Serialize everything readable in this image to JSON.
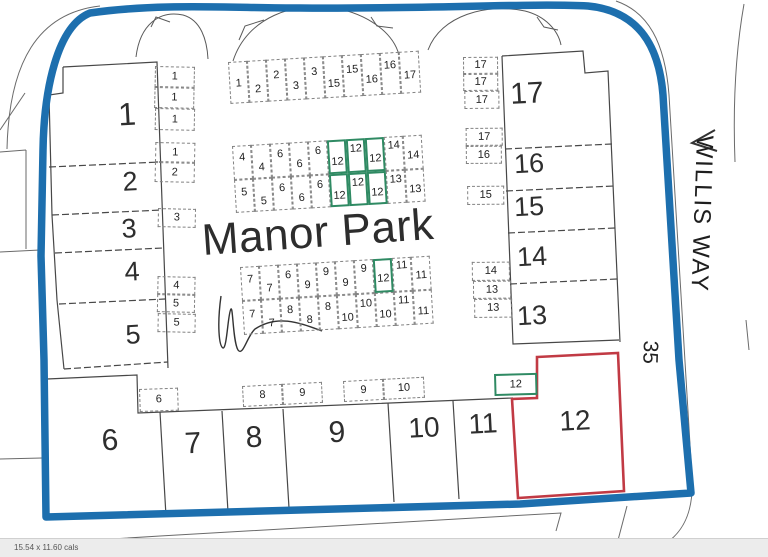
{
  "title": {
    "text": "Manor Park"
  },
  "street": {
    "name": "WILLIS WAY",
    "number": "35"
  },
  "status_bar": {
    "left_text": "15.54 x 11.60 cals"
  },
  "colors": {
    "boundary": "#1d6fae",
    "highlight_red": "#c13a44",
    "highlight_green": "#2f8a63",
    "plot_line": "#474747"
  },
  "plots": [
    {
      "label": "1",
      "x": 127,
      "y": 114,
      "fs": 32
    },
    {
      "label": "2",
      "x": 130,
      "y": 182,
      "fs": 27
    },
    {
      "label": "3",
      "x": 129,
      "y": 229,
      "fs": 27
    },
    {
      "label": "4",
      "x": 132,
      "y": 272,
      "fs": 27
    },
    {
      "label": "5",
      "x": 133,
      "y": 335,
      "fs": 27
    },
    {
      "label": "6",
      "x": 110,
      "y": 441,
      "fs": 30
    },
    {
      "label": "7",
      "x": 193,
      "y": 444,
      "fs": 30
    },
    {
      "label": "8",
      "x": 254,
      "y": 438,
      "fs": 30
    },
    {
      "label": "9",
      "x": 337,
      "y": 433,
      "fs": 30
    },
    {
      "label": "10",
      "x": 424,
      "y": 428,
      "fs": 28
    },
    {
      "label": "11",
      "x": 483,
      "y": 424,
      "fs": 28
    },
    {
      "label": "12",
      "x": 575,
      "y": 421,
      "fs": 28
    },
    {
      "label": "13",
      "x": 532,
      "y": 316,
      "fs": 27
    },
    {
      "label": "14",
      "x": 532,
      "y": 257,
      "fs": 27
    },
    {
      "label": "15",
      "x": 529,
      "y": 207,
      "fs": 27
    },
    {
      "label": "16",
      "x": 529,
      "y": 164,
      "fs": 27
    },
    {
      "label": "17",
      "x": 527,
      "y": 94,
      "fs": 30
    }
  ],
  "garage_groups": [
    {
      "name": "garage-strip-left",
      "x": 155,
      "y": 66,
      "a": 1.2,
      "cells": [
        {
          "l": "1",
          "dx": 0,
          "dy": 0,
          "w": 40,
          "h": 21,
          "lo": 0
        },
        {
          "l": "1",
          "dx": 0,
          "dy": 21,
          "w": 40,
          "h": 21,
          "lo": 0
        },
        {
          "l": "1",
          "dx": 1,
          "dy": 42,
          "w": 40,
          "h": 22,
          "lo": 0
        },
        {
          "l": "1",
          "dx": 2,
          "dy": 76,
          "w": 40,
          "h": 20,
          "lo": 0
        },
        {
          "l": "2",
          "dx": 2,
          "dy": 96,
          "w": 40,
          "h": 20,
          "lo": 0
        },
        {
          "l": "3",
          "dx": 6,
          "dy": 142,
          "w": 38,
          "h": 19,
          "lo": 0
        },
        {
          "l": "4",
          "dx": 7,
          "dy": 210,
          "w": 38,
          "h": 18,
          "lo": 0
        },
        {
          "l": "5",
          "dx": 7,
          "dy": 228,
          "w": 38,
          "h": 18,
          "lo": 0
        },
        {
          "l": "5",
          "dx": 8,
          "dy": 247,
          "w": 38,
          "h": 19,
          "lo": 0
        }
      ]
    },
    {
      "name": "garage-row-top",
      "x": 228,
      "y": 62,
      "a": -3.4,
      "cells": [
        {
          "l": "1",
          "dx": 0,
          "dy": 0,
          "w": 19,
          "h": 42,
          "lo": 1
        },
        {
          "l": "2",
          "dx": 19,
          "dy": 0,
          "w": 19,
          "h": 42,
          "lo": 8
        },
        {
          "l": "2",
          "dx": 38,
          "dy": 0,
          "w": 19,
          "h": 42,
          "lo": -5
        },
        {
          "l": "3",
          "dx": 57,
          "dy": 0,
          "w": 19,
          "h": 42,
          "lo": 7
        },
        {
          "l": "3",
          "dx": 76,
          "dy": 0,
          "w": 19,
          "h": 42,
          "lo": -6
        },
        {
          "l": "15",
          "dx": 95,
          "dy": 0,
          "w": 19,
          "h": 42,
          "lo": 7
        },
        {
          "l": "15",
          "dx": 114,
          "dy": 0,
          "w": 19,
          "h": 42,
          "lo": -6
        },
        {
          "l": "16",
          "dx": 133,
          "dy": 0,
          "w": 19,
          "h": 42,
          "lo": 5
        },
        {
          "l": "16",
          "dx": 152,
          "dy": 0,
          "w": 19,
          "h": 42,
          "lo": -8
        },
        {
          "l": "17",
          "dx": 171,
          "dy": 0,
          "w": 20,
          "h": 42,
          "lo": 3
        }
      ]
    },
    {
      "name": "garage-block-upper",
      "x": 232,
      "y": 146,
      "a": -3.4,
      "cells": [
        {
          "l": "4",
          "dx": 0,
          "dy": 0,
          "w": 19,
          "h": 34,
          "lo": -5
        },
        {
          "l": "4",
          "dx": 19,
          "dy": 0,
          "w": 19,
          "h": 34,
          "lo": 6
        },
        {
          "l": "6",
          "dx": 38,
          "dy": 0,
          "w": 19,
          "h": 34,
          "lo": -6
        },
        {
          "l": "6",
          "dx": 57,
          "dy": 0,
          "w": 19,
          "h": 34,
          "lo": 5
        },
        {
          "l": "6",
          "dx": 76,
          "dy": 0,
          "w": 19,
          "h": 34,
          "lo": -7
        },
        {
          "l": "12",
          "dx": 95,
          "dy": 0,
          "w": 19,
          "h": 34,
          "lo": 5,
          "g": true
        },
        {
          "l": "12",
          "dx": 114,
          "dy": 0,
          "w": 19,
          "h": 34,
          "lo": -7,
          "g": true
        },
        {
          "l": "12",
          "dx": 133,
          "dy": 0,
          "w": 19,
          "h": 34,
          "lo": 4,
          "g": true
        },
        {
          "l": "14",
          "dx": 152,
          "dy": 0,
          "w": 19,
          "h": 34,
          "lo": -8
        },
        {
          "l": "14",
          "dx": 171,
          "dy": 0,
          "w": 19,
          "h": 34,
          "lo": 3
        },
        {
          "l": "5",
          "dx": 0,
          "dy": 34,
          "w": 19,
          "h": 33,
          "lo": -3
        },
        {
          "l": "5",
          "dx": 19,
          "dy": 34,
          "w": 19,
          "h": 33,
          "lo": 7
        },
        {
          "l": "6",
          "dx": 38,
          "dy": 34,
          "w": 19,
          "h": 33,
          "lo": -5
        },
        {
          "l": "6",
          "dx": 57,
          "dy": 34,
          "w": 19,
          "h": 33,
          "lo": 6
        },
        {
          "l": "6",
          "dx": 76,
          "dy": 34,
          "w": 19,
          "h": 33,
          "lo": -6
        },
        {
          "l": "12",
          "dx": 95,
          "dy": 34,
          "w": 19,
          "h": 33,
          "lo": 6,
          "g": true
        },
        {
          "l": "12",
          "dx": 114,
          "dy": 34,
          "w": 19,
          "h": 33,
          "lo": -6,
          "g": true
        },
        {
          "l": "12",
          "dx": 133,
          "dy": 34,
          "w": 19,
          "h": 33,
          "lo": 5,
          "g": true
        },
        {
          "l": "13",
          "dx": 152,
          "dy": 34,
          "w": 19,
          "h": 33,
          "lo": -7
        },
        {
          "l": "13",
          "dx": 171,
          "dy": 34,
          "w": 19,
          "h": 33,
          "lo": 4
        }
      ]
    },
    {
      "name": "garage-block-lower",
      "x": 240,
      "y": 267,
      "a": -3.4,
      "cells": [
        {
          "l": "7",
          "dx": 0,
          "dy": 0,
          "w": 19,
          "h": 34,
          "lo": -4
        },
        {
          "l": "7",
          "dx": 19,
          "dy": 0,
          "w": 19,
          "h": 34,
          "lo": 6
        },
        {
          "l": "6",
          "dx": 38,
          "dy": 0,
          "w": 19,
          "h": 34,
          "lo": -6
        },
        {
          "l": "9",
          "dx": 57,
          "dy": 0,
          "w": 19,
          "h": 34,
          "lo": 5
        },
        {
          "l": "9",
          "dx": 76,
          "dy": 0,
          "w": 19,
          "h": 34,
          "lo": -7
        },
        {
          "l": "9",
          "dx": 95,
          "dy": 0,
          "w": 19,
          "h": 34,
          "lo": 5
        },
        {
          "l": "9",
          "dx": 114,
          "dy": 0,
          "w": 19,
          "h": 34,
          "lo": -8
        },
        {
          "l": "12",
          "dx": 133,
          "dy": 0,
          "w": 19,
          "h": 34,
          "lo": 3,
          "g": true
        },
        {
          "l": "11",
          "dx": 152,
          "dy": 0,
          "w": 19,
          "h": 34,
          "lo": -9
        },
        {
          "l": "11",
          "dx": 171,
          "dy": 0,
          "w": 19,
          "h": 34,
          "lo": 2
        },
        {
          "l": "7",
          "dx": 0,
          "dy": 34,
          "w": 19,
          "h": 34,
          "lo": -3
        },
        {
          "l": "7",
          "dx": 19,
          "dy": 34,
          "w": 19,
          "h": 34,
          "lo": 7
        },
        {
          "l": "8",
          "dx": 38,
          "dy": 34,
          "w": 19,
          "h": 34,
          "lo": -5
        },
        {
          "l": "8",
          "dx": 57,
          "dy": 34,
          "w": 19,
          "h": 34,
          "lo": 6
        },
        {
          "l": "8",
          "dx": 76,
          "dy": 34,
          "w": 19,
          "h": 34,
          "lo": -6
        },
        {
          "l": "10",
          "dx": 95,
          "dy": 34,
          "w": 19,
          "h": 34,
          "lo": 6
        },
        {
          "l": "10",
          "dx": 114,
          "dy": 34,
          "w": 19,
          "h": 34,
          "lo": -7
        },
        {
          "l": "10",
          "dx": 133,
          "dy": 34,
          "w": 19,
          "h": 34,
          "lo": 5
        },
        {
          "l": "11",
          "dx": 152,
          "dy": 34,
          "w": 19,
          "h": 34,
          "lo": -8
        },
        {
          "l": "11",
          "dx": 171,
          "dy": 34,
          "w": 19,
          "h": 34,
          "lo": 4
        }
      ]
    },
    {
      "name": "garage-col-right",
      "x": 463,
      "y": 57,
      "a": -0.5,
      "cells": [
        {
          "l": "17",
          "dx": 0,
          "dy": 0,
          "w": 35,
          "h": 17,
          "lo": 0
        },
        {
          "l": "17",
          "dx": 0,
          "dy": 17,
          "w": 35,
          "h": 17,
          "lo": 0
        },
        {
          "l": "17",
          "dx": 1,
          "dy": 34,
          "w": 35,
          "h": 18,
          "lo": 0
        },
        {
          "l": "17",
          "dx": 2,
          "dy": 71,
          "w": 37,
          "h": 18,
          "lo": 0
        },
        {
          "l": "16",
          "dx": 2,
          "dy": 89,
          "w": 36,
          "h": 18,
          "lo": 0
        },
        {
          "l": "15",
          "dx": 3,
          "dy": 129,
          "w": 37,
          "h": 19,
          "lo": 0
        },
        {
          "l": "14",
          "dx": 7,
          "dy": 205,
          "w": 38,
          "h": 19,
          "lo": 0
        },
        {
          "l": "13",
          "dx": 8,
          "dy": 224,
          "w": 38,
          "h": 18,
          "lo": 0
        },
        {
          "l": "13",
          "dx": 9,
          "dy": 242,
          "w": 38,
          "h": 19,
          "lo": 0
        }
      ]
    },
    {
      "name": "garage-cell-6",
      "x": 139,
      "y": 389,
      "a": -2,
      "cells": [
        {
          "l": "6",
          "dx": 0,
          "dy": 0,
          "w": 39,
          "h": 23,
          "lo": 0
        }
      ]
    },
    {
      "name": "garage-cells-8-9",
      "x": 242,
      "y": 386,
      "a": -3,
      "cells": [
        {
          "l": "8",
          "dx": 0,
          "dy": 0,
          "w": 40,
          "h": 21,
          "lo": 0
        },
        {
          "l": "9",
          "dx": 40,
          "dy": 0,
          "w": 40,
          "h": 21,
          "lo": 0
        }
      ]
    },
    {
      "name": "garage-cells-9-10",
      "x": 343,
      "y": 381,
      "a": -3,
      "cells": [
        {
          "l": "9",
          "dx": 0,
          "dy": 0,
          "w": 40,
          "h": 21,
          "lo": 0
        },
        {
          "l": "10",
          "dx": 40,
          "dy": 0,
          "w": 41,
          "h": 21,
          "lo": 0
        }
      ]
    },
    {
      "name": "plot12-garage-green",
      "x": 494,
      "y": 374,
      "a": -1.5,
      "cells": [
        {
          "l": "12",
          "dx": 0,
          "dy": 0,
          "w": 43,
          "h": 22,
          "lo": 0,
          "g": true
        }
      ]
    }
  ]
}
